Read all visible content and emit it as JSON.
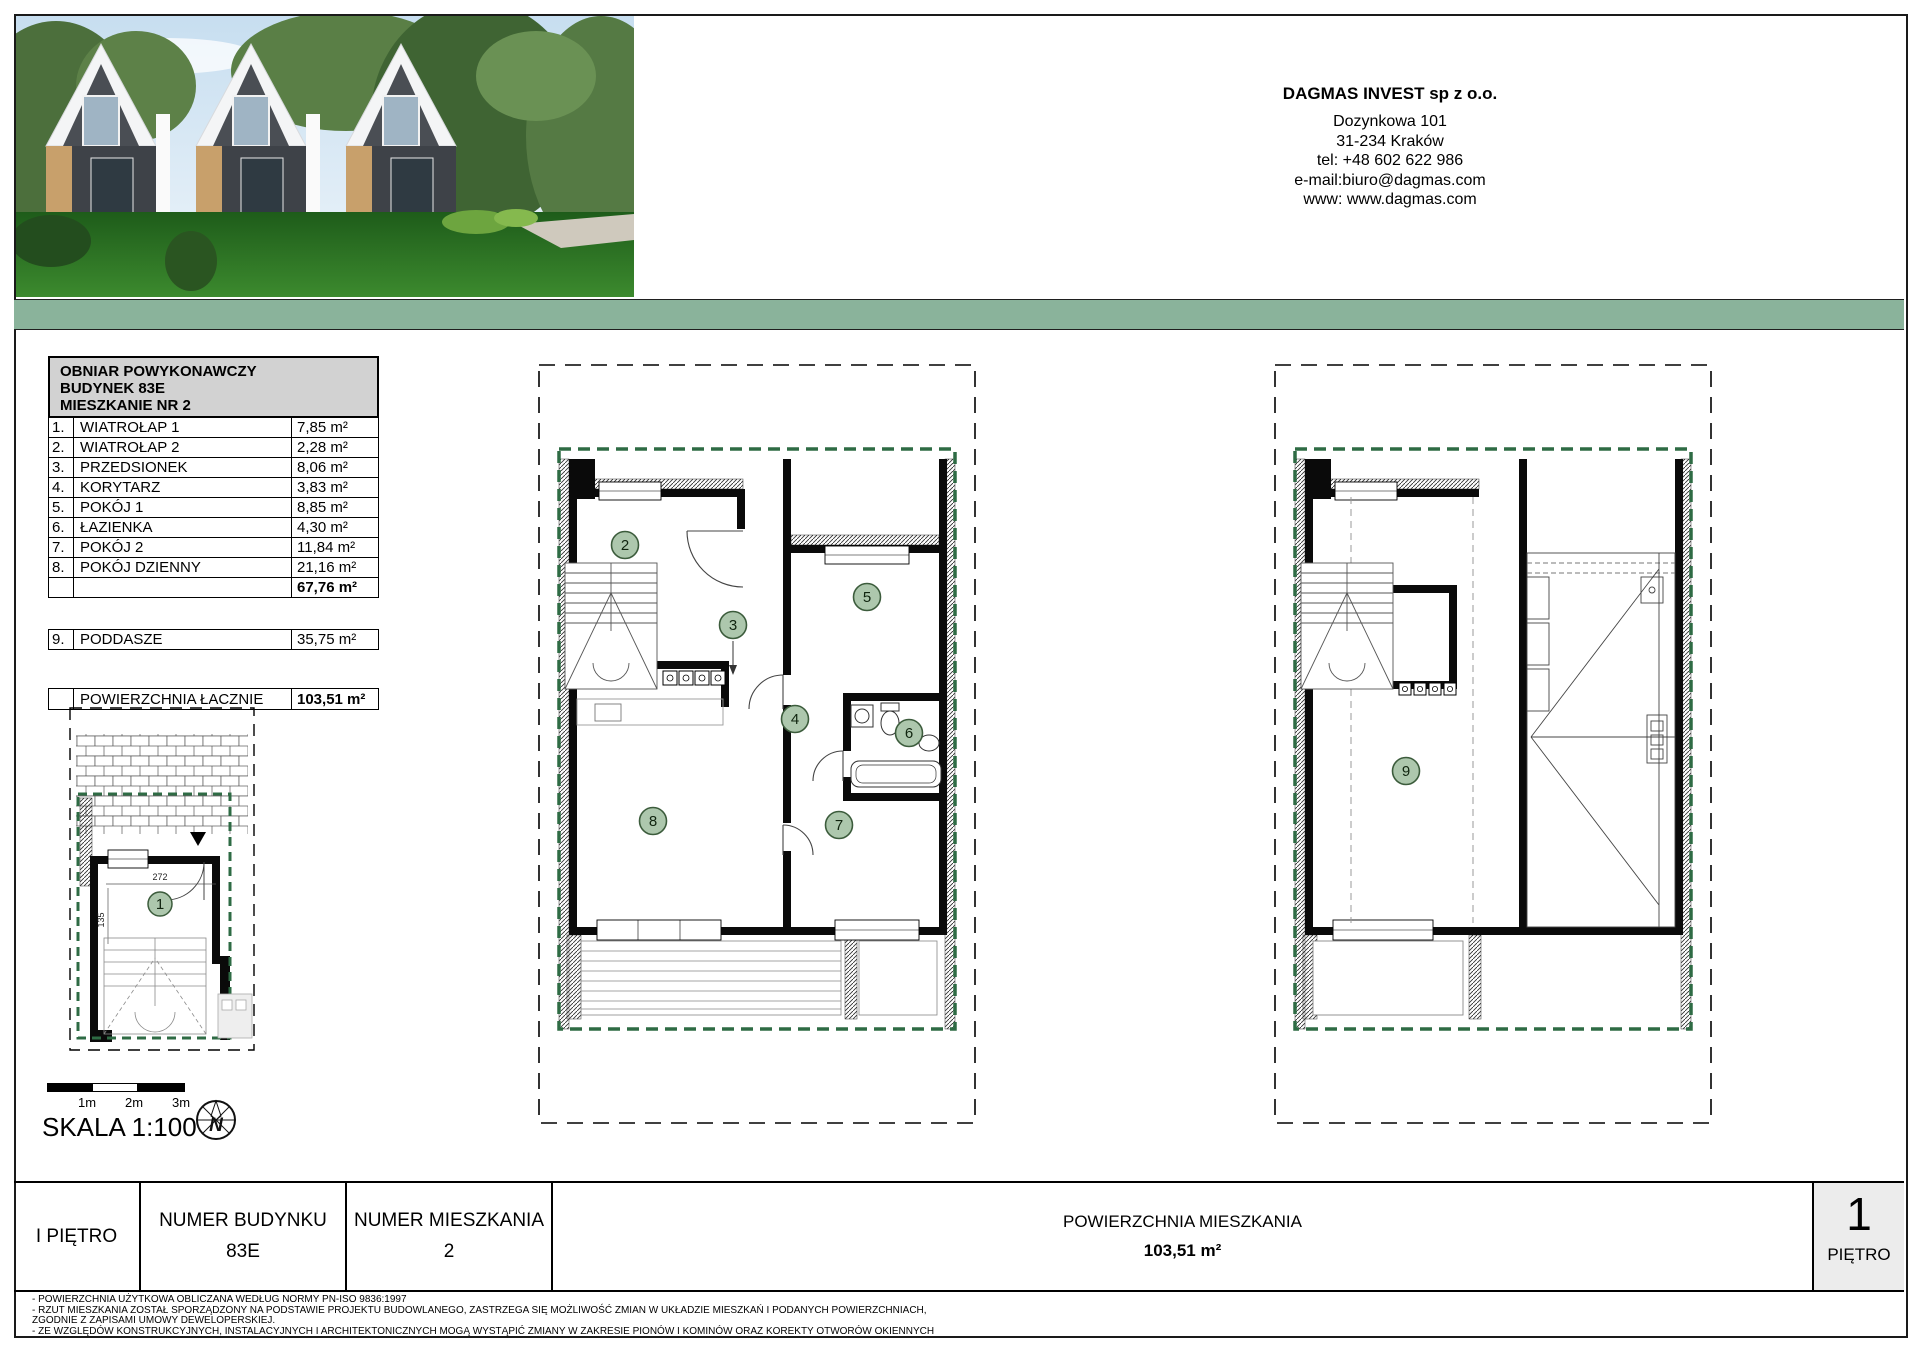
{
  "company": {
    "name": "DAGMAS INVEST sp z o.o.",
    "address_line1": "Dozynkowa 101",
    "address_line2": "31-234 Kraków",
    "phone": "tel: +48 602 622 986",
    "email": "e-mail:biuro@dagmas.com",
    "www": "www: www.dagmas.com"
  },
  "area_table": {
    "title_lines": [
      "OBNIAR POWYKONAWCZY",
      "BUDYNEK 83E",
      "MIESZKANIE NR 2"
    ],
    "rows": [
      {
        "no": "1.",
        "name": "WIATROŁAP 1",
        "area": "7,85 m²"
      },
      {
        "no": "2.",
        "name": "WIATROŁAP 2",
        "area": "2,28 m²"
      },
      {
        "no": "3.",
        "name": "PRZEDSIONEK",
        "area": "8,06 m²"
      },
      {
        "no": "4.",
        "name": "KORYTARZ",
        "area": "3,83 m²"
      },
      {
        "no": "5.",
        "name": "POKÓJ 1",
        "area": "8,85 m²"
      },
      {
        "no": "6.",
        "name": "ŁAZIENKA",
        "area": "4,30 m²"
      },
      {
        "no": "7.",
        "name": "POKÓJ 2",
        "area": "11,84 m²"
      },
      {
        "no": "8.",
        "name": "POKÓJ DZIENNY",
        "area": "21,16 m²"
      }
    ],
    "subtotal_area": "67,76 m²",
    "attic_row": {
      "no": "9.",
      "name": "PODDASZE",
      "area": "35,75 m²"
    },
    "total_row": {
      "name": "POWIERZCHNIA ŁACZNIE",
      "area": "103,51 m²"
    }
  },
  "plans": {
    "room_numbers": {
      "n1": "1",
      "n2": "2",
      "n3": "3",
      "n4": "4",
      "n5": "5",
      "n6": "6",
      "n7": "7",
      "n8": "8",
      "n9": "9"
    },
    "dims": {
      "w": "272",
      "h": "135"
    }
  },
  "scale_bar": {
    "ticks": [
      "1m",
      "2m",
      "3m"
    ],
    "label": "SKALA 1:100",
    "compass_letter": "N"
  },
  "footer": {
    "cells": [
      {
        "label": "I PIĘTRO"
      },
      {
        "label": "NUMER BUDYNKU",
        "value": "83E"
      },
      {
        "label": "NUMER MIESZKANIA",
        "value": "2"
      },
      {
        "label": "POWIERZCHNIA MIESZKANIA",
        "value": "103,51 m²"
      }
    ],
    "floor_box": {
      "number": "1",
      "label": "PIĘTRO"
    }
  },
  "notes": [
    "- POWIERZCHNIA UŻYTKOWA OBLICZANA WEDŁUG NORMY PN-ISO 9836:1997",
    "- RZUT MIESZKANIA ZOSTAŁ SPORZĄDZONY NA PODSTAWIE PROJEKTU BUDOWLANEGO, ZASTRZEGA SIĘ MOŻLIWOŚĆ ZMIAN W UKŁADZIE MIESZKAŃ I PODANYCH POWIERZCHNIACH,",
    "ZGODNIE Z ZAPISAMI UMOWY DEWELOPERSKIEJ.",
    "- ZE WZGLĘDÓW KONSTRUKCYJNYCH, INSTALACYJNYCH I ARCHITEKTONICZNYCH MOGĄ WYSTĄPIĆ ZMIANY W  ZAKRESIE PIONÓW I KOMINÓW ORAZ KOREKTY OTWORÓW OKIENNYCH"
  ],
  "colors": {
    "green_bar": "#8ab39b",
    "plan_boundary_green": "#2e6b44",
    "room_badge_fill": "#adc7ad"
  }
}
